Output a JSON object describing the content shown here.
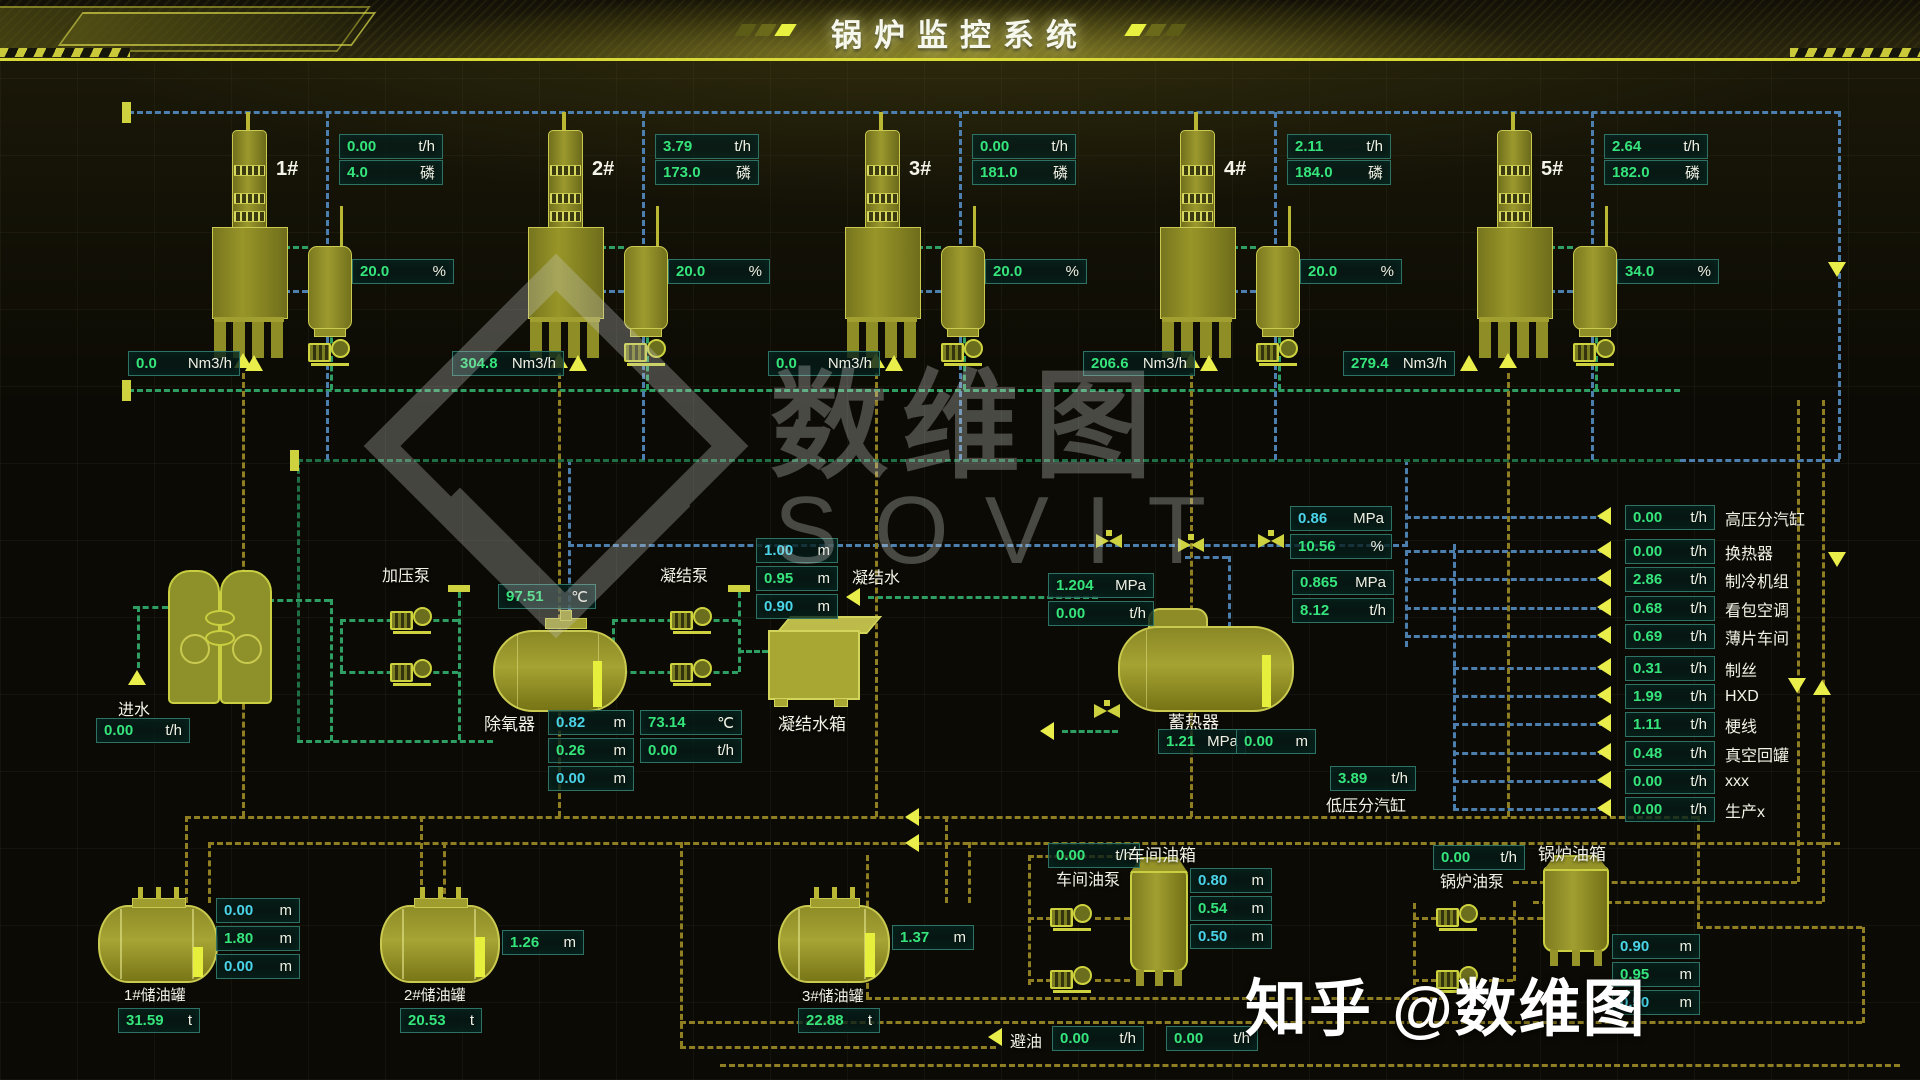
{
  "header": {
    "title": "锅炉监控系统"
  },
  "units": {
    "th": "t/h",
    "phos": "磷",
    "pct": "%",
    "nm3": "Nm3/h",
    "m": "m",
    "mpa": "MPa",
    "c": "℃",
    "t": "t"
  },
  "boilers": [
    {
      "id": "1#",
      "flow": "0.00",
      "phos": "4.0",
      "pct": "20.0",
      "nm3": "0.0"
    },
    {
      "id": "2#",
      "flow": "3.79",
      "phos": "173.0",
      "pct": "20.0",
      "nm3": "304.8"
    },
    {
      "id": "3#",
      "flow": "0.00",
      "phos": "181.0",
      "pct": "20.0",
      "nm3": "0.0"
    },
    {
      "id": "4#",
      "flow": "2.11",
      "phos": "184.0",
      "pct": "20.0",
      "nm3": "206.6"
    },
    {
      "id": "5#",
      "flow": "2.64",
      "phos": "182.0",
      "pct": "34.0",
      "nm3": "279.4"
    }
  ],
  "left": {
    "inlet_label": "进水",
    "inlet_flow": "0.00"
  },
  "middle": {
    "pressure_pump_label": "加压泵",
    "cond_pump_label": "凝结泵",
    "cond_water_label": "凝结水",
    "deaerator_label": "除氧器",
    "deaerator_temp": "97.51",
    "dea_levels": [
      "0.82",
      "0.26",
      "0.00"
    ],
    "cond_temp": "73.14",
    "cond_flow": "0.00",
    "cond_levels": [
      "1.00",
      "0.95",
      "0.90"
    ],
    "cond_tank_label": "凝结水箱",
    "acc_label": "蓄热器",
    "acc_pressure": "1.21",
    "acc_level": "0.00",
    "line_pressure": "1.204",
    "line_flow": "0.00",
    "p2": "0.86",
    "pct2": "10.56",
    "p3": "0.865",
    "f3": "8.12",
    "lp_flow": "3.89",
    "lp_label": "低压分汽缸"
  },
  "consumers": [
    {
      "value": "0.00",
      "label": "高压分汽缸"
    },
    {
      "value": "0.00",
      "label": "换热器"
    },
    {
      "value": "2.86",
      "label": "制冷机组"
    },
    {
      "value": "0.68",
      "label": "看包空调"
    },
    {
      "value": "0.69",
      "label": "薄片车间"
    },
    {
      "value": "0.31",
      "label": "制丝"
    },
    {
      "value": "1.99",
      "label": "HXD"
    },
    {
      "value": "1.11",
      "label": "梗线"
    },
    {
      "value": "0.48",
      "label": "真空回罐"
    },
    {
      "value": "0.00",
      "label": "xxx"
    },
    {
      "value": "0.00",
      "label": "生产x"
    }
  ],
  "bottom": {
    "tank1": {
      "label": "1#储油罐",
      "levels": [
        "0.00",
        "1.80",
        "0.00"
      ],
      "weight": "31.59"
    },
    "tank2": {
      "label": "2#储油罐",
      "level": "1.26",
      "weight": "20.53"
    },
    "tank3": {
      "label": "3#储油罐",
      "level": "1.37",
      "weight": "22.88"
    },
    "shop_pump_label": "车间油泵",
    "shop_pump_flow": "0.00",
    "shop_tank_label": "车间油箱",
    "shop_levels": [
      "0.80",
      "0.54",
      "0.50"
    ],
    "boiler_pump_label": "锅炉油泵",
    "boiler_pump_flow": "0.00",
    "boiler_tank_label": "锅炉油箱",
    "boiler_levels": [
      "0.90",
      "0.95",
      "0.50"
    ],
    "drain_label": "避油",
    "drain_flow": "0.00",
    "extra_flow": "0.00"
  },
  "watermark": {
    "center_cn": "数维图",
    "center_en": "SOVIT",
    "credit": "知乎 @数维图"
  }
}
